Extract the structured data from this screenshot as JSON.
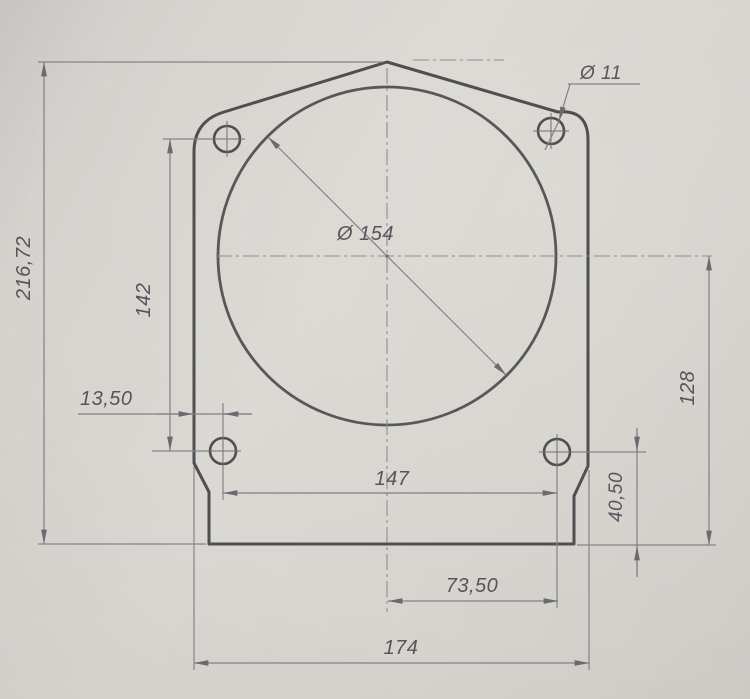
{
  "drawing": {
    "type": "technical-drawing",
    "view": "mounting-plate-front-view",
    "labels": {
      "overall_height": "216,72",
      "bolt_vertical_spacing": "142",
      "edge_to_hole_offset": "13,50",
      "bolt_horizontal_spacing": "147",
      "center_to_right_hole": "73,50",
      "overall_width": "174",
      "center_to_bottom_edge": "128",
      "hole_to_bottom_edge": "40,50",
      "main_bore_diameter": "Ø 154",
      "bolt_hole_diameter": "Ø 11"
    },
    "colors": {
      "paper": "#d8d5d0",
      "outline": "#4e4f51",
      "dimension_lines": "#7f8086",
      "text": "#55565b"
    }
  }
}
